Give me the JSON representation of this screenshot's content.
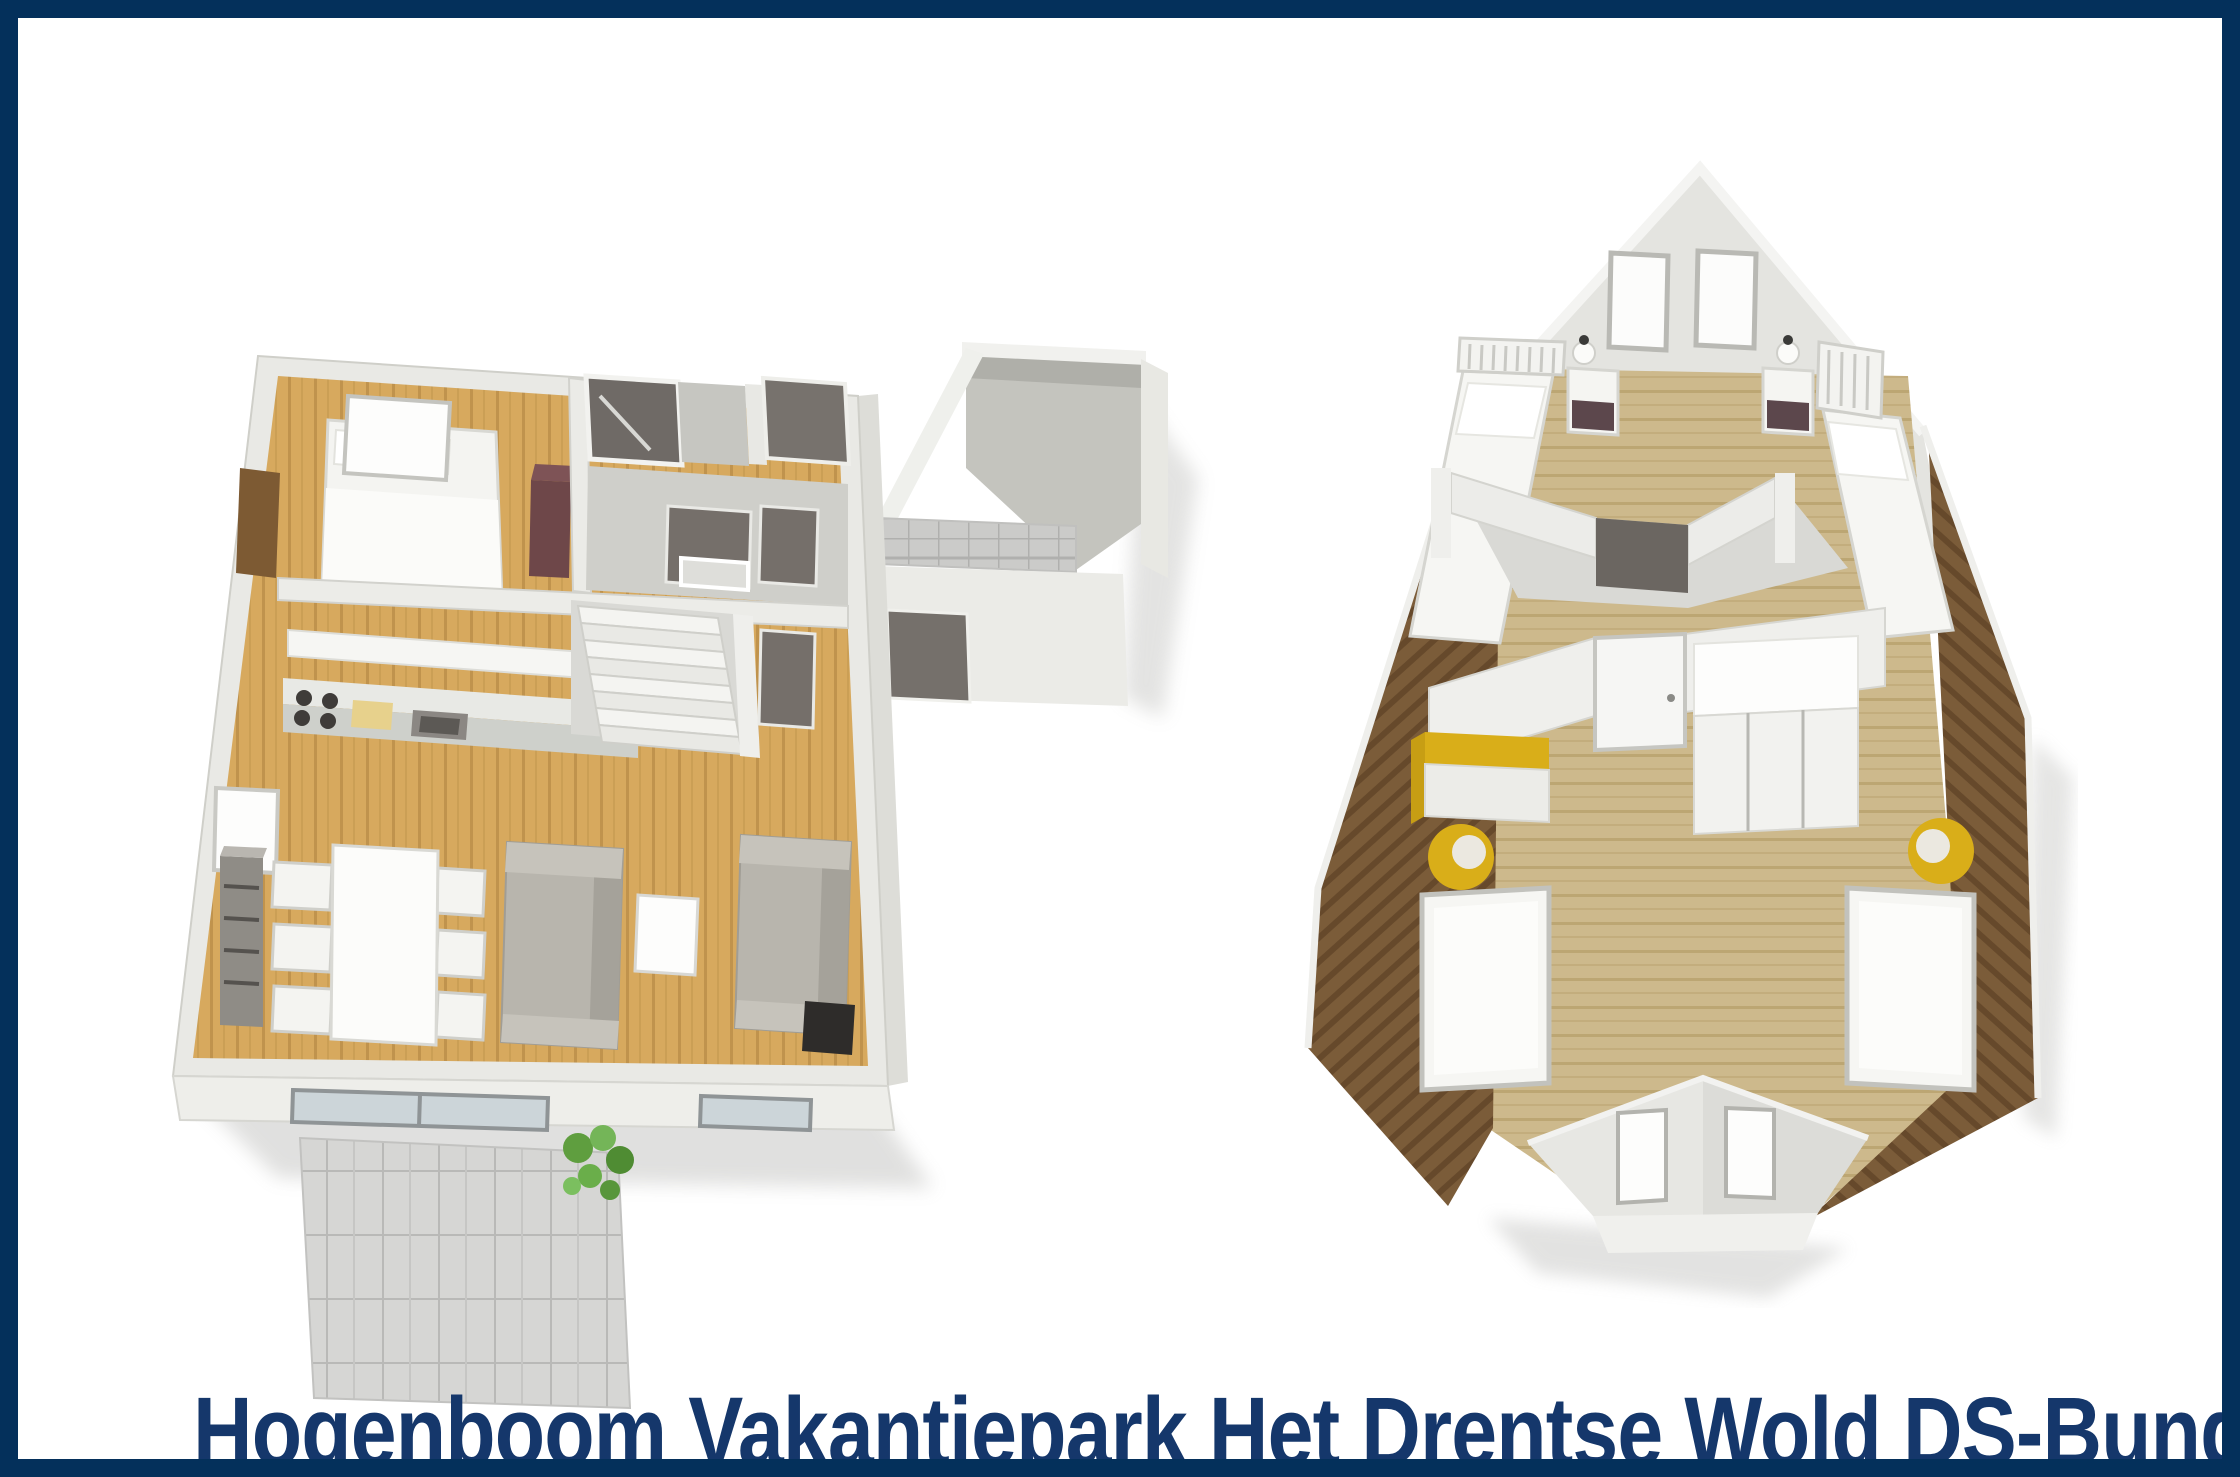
{
  "page": {
    "width_px": 2240,
    "height_px": 1477,
    "background": "#ffffff",
    "frame_color": "#04305b",
    "frame_width_px": 18
  },
  "caption": {
    "text": "Hogenboom Vakantiepark Het Drentse Wold DS-Bungal",
    "color": "#15376b"
  },
  "figures": {
    "ground_floor": {
      "label": "ground-floor-plan",
      "view": "3d-isometric-floorplan",
      "rooms": [
        "bedroom",
        "bathroom",
        "toilet-room",
        "hallway",
        "kitchen",
        "living-dining-room",
        "staircase",
        "patio-terrace",
        "storage-annex"
      ],
      "furniture": [
        "double-bed",
        "window",
        "entry-door",
        "maroon-wardrobe",
        "kitchen-counter",
        "stove",
        "sink",
        "cutting-board",
        "upper-cabinets",
        "dining-table",
        "six-chairs",
        "sideboard",
        "sofa",
        "wall-sofa",
        "coffee-table",
        "tv",
        "sliding-glass-door",
        "window",
        "patio-tiles",
        "plant"
      ]
    },
    "upper_floor": {
      "label": "first-floor-plan",
      "view": "3d-isometric-floorplan",
      "rooms": [
        "bedroom-north",
        "landing",
        "bedroom-south",
        "dormer"
      ],
      "furniture": [
        "single-bed",
        "single-bed",
        "slatted-headboard",
        "slatted-headboard",
        "nightstand",
        "nightstand",
        "lamp",
        "lamp",
        "gable-window",
        "gable-window",
        "doorway",
        "door",
        "wardrobe",
        "yellow-desk",
        "yellow-tub-chair",
        "yellow-tub-chair",
        "single-bed",
        "single-bed",
        "dormer-window",
        "dormer-window"
      ]
    }
  },
  "palette": {
    "frame_navy": "#04305b",
    "caption_navy": "#15376b",
    "wall_white": "#e9e9e5",
    "wall_shade": "#cfcfc9",
    "interior_dark": "#6f6a66",
    "wood_floor": "#d7a95e",
    "wood_floor_stripe": "#c0934d",
    "pale_wood": "#cdb98c",
    "pale_wood_stripe": "#bca673",
    "roof_brown": "#7b5c39",
    "roof_stripe": "#66492b",
    "accent_yellow": "#d9ae19",
    "wardrobe_maroon": "#6e4749",
    "sofa_gray": "#b8b5ad",
    "tile_gray": "#d6d6d4",
    "glass_blue": "#ccd5d9",
    "plant_green": "#5f9e3f",
    "entry_door_brown": "#7d5a33"
  }
}
